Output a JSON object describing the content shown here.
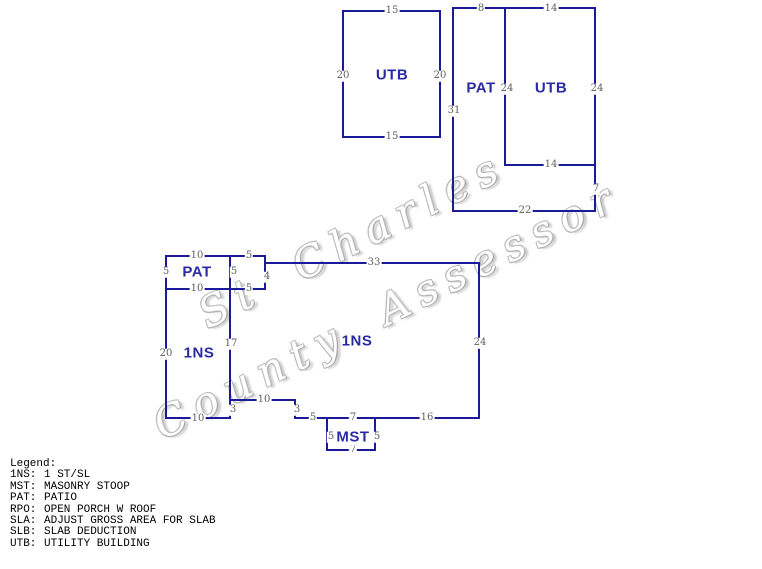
{
  "watermark": {
    "line1": "St Charles",
    "line2": "County Assessor"
  },
  "shed": {
    "label": "UTB",
    "dim_top": "15",
    "dim_left": "20",
    "dim_right": "20",
    "dim_bottom": "15"
  },
  "outbuilding": {
    "pat_label": "PAT",
    "utb_label": "UTB",
    "dim_pat_top": "8",
    "dim_utb_top": "14",
    "dim_divider": "24",
    "dim_right": "24",
    "dim_left": "31",
    "dim_utb_bottom": "14",
    "dim_right_lower": "7",
    "dim_bottom": "22"
  },
  "house": {
    "pat_label": "PAT",
    "left_label": "1NS",
    "main_label": "1NS",
    "mst_label": "MST",
    "dim_pat_top": "10",
    "dim_pat_left": "5",
    "dim_pat_right": "5",
    "dim_pat_bottom": "10",
    "dim_entry_top": "5",
    "dim_entry_right": "4",
    "dim_entry_bottom": "5",
    "dim_main_top": "33",
    "dim_main_right": "24",
    "dim_mid": "17",
    "dim_left": "20",
    "dim_notch_top": "10",
    "dim_notch_left": "3",
    "dim_notch_right": "3",
    "dim_left_bottom": "10",
    "dim_bottom_left": "5",
    "dim_bottom_mst": "7",
    "dim_bottom_right": "16",
    "dim_mst_left": "5",
    "dim_mst_right": "5",
    "dim_mst_bottom": "7"
  },
  "legend": {
    "title": "Legend:",
    "entries": [
      {
        "abbr": "1NS:",
        "desc": "1 ST/SL"
      },
      {
        "abbr": "MST:",
        "desc": "MASONRY STOOP"
      },
      {
        "abbr": "PAT:",
        "desc": "PATIO"
      },
      {
        "abbr": "RPO:",
        "desc": "OPEN PORCH W ROOF"
      },
      {
        "abbr": "SLA:",
        "desc": "ADJUST GROSS AREA FOR SLAB"
      },
      {
        "abbr": "SLB:",
        "desc": "SLAB DEDUCTION"
      },
      {
        "abbr": "UTB:",
        "desc": "UTILITY BUILDING"
      }
    ]
  }
}
